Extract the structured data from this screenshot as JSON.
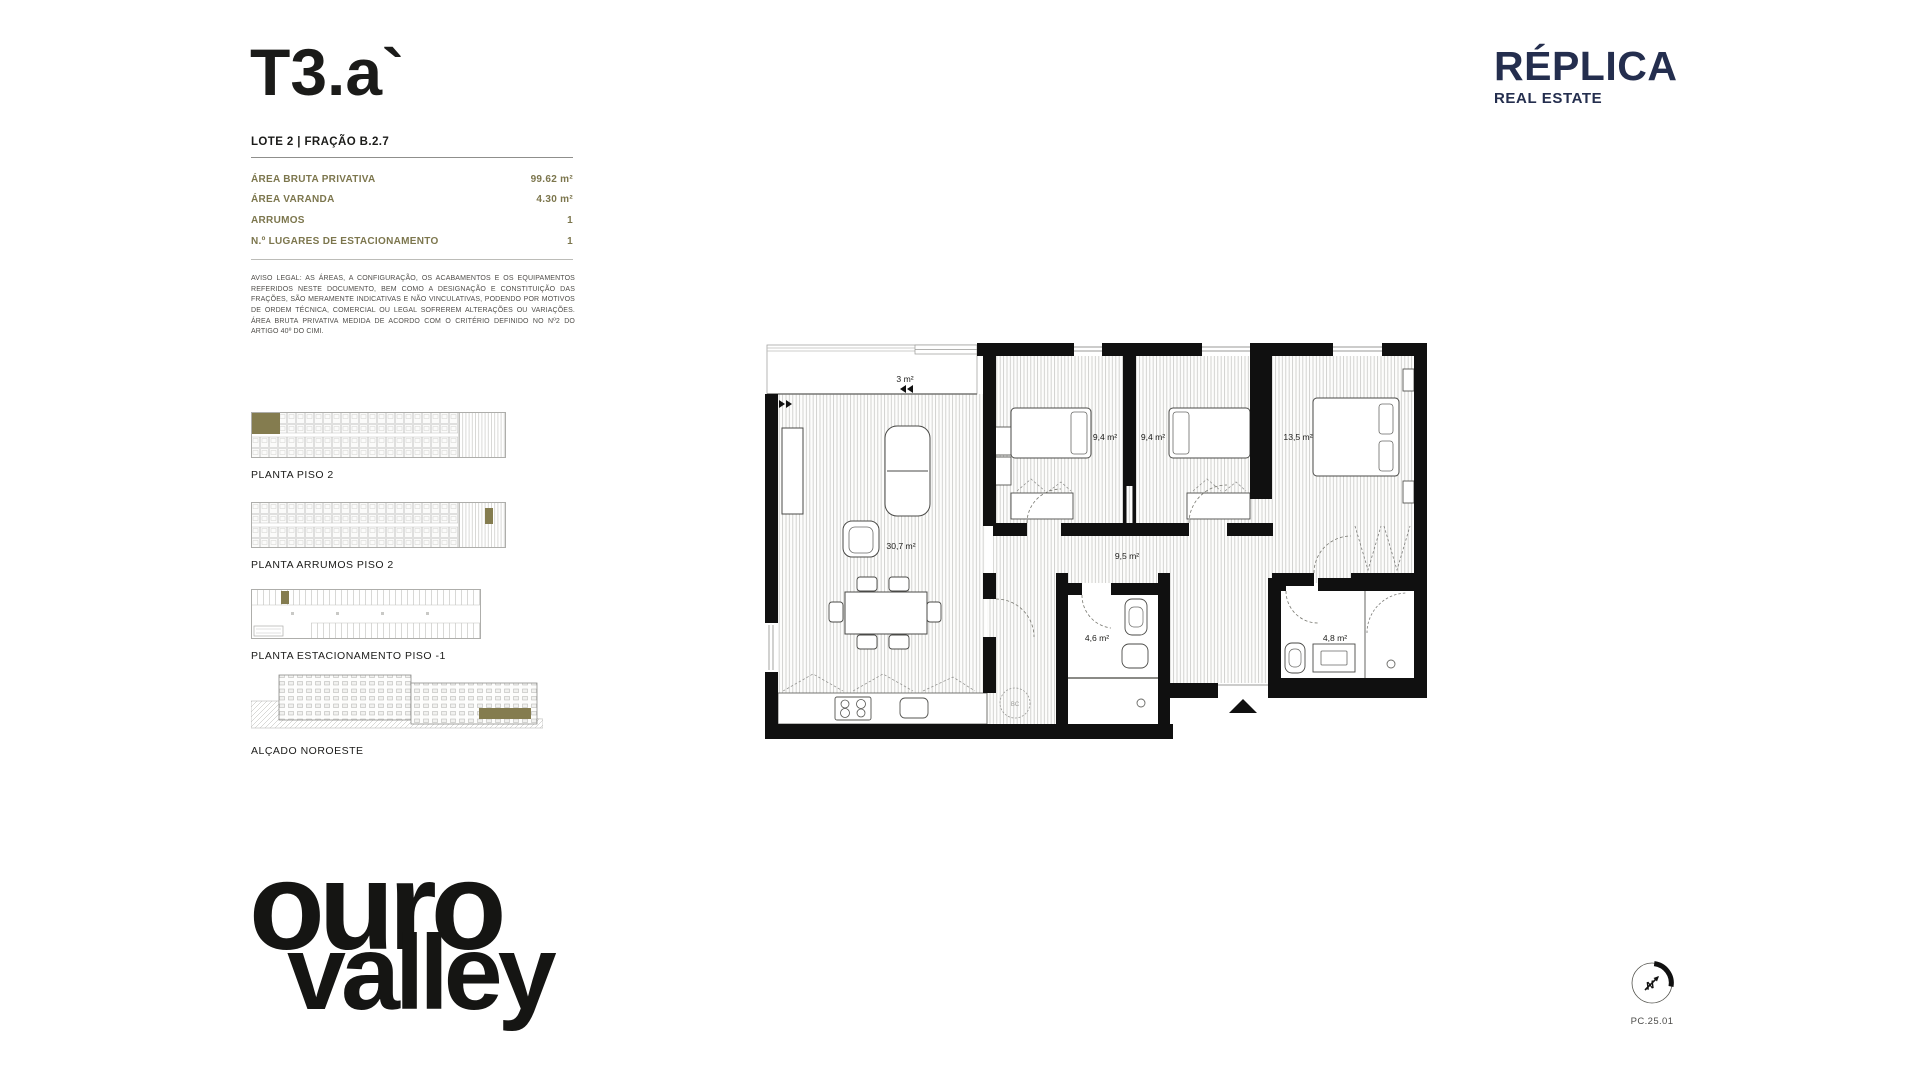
{
  "theme": {
    "accent_olive": "#847C4F",
    "brand_navy": "#242E4E",
    "ink": "#1B1B19"
  },
  "header": {
    "title": "T3.a`",
    "subtitle": "LOTE 2 | FRAÇÃO B.2.7"
  },
  "brand": {
    "name": "RÉPLICA",
    "tagline": "REAL ESTATE"
  },
  "specs": {
    "rows": [
      {
        "label": "ÁREA BRUTA PRIVATIVA",
        "value": "99.62 m²"
      },
      {
        "label": "ÁREA VARANDA",
        "value": "4.30 m²"
      },
      {
        "label": "ARRUMOS",
        "value": "1"
      },
      {
        "label": "N.º LUGARES DE ESTACIONAMENTO",
        "value": "1"
      }
    ]
  },
  "legal": "AVISO LEGAL: AS ÁREAS, A CONFIGURAÇÃO, OS ACABAMENTOS E OS EQUIPAMENTOS REFERIDOS NESTE DOCUMENTO, BEM COMO A DESIGNAÇÃO E CONSTITUIÇÃO DAS FRAÇÕES, SÃO MERAMENTE INDICATIVAS E NÃO VINCULATIVAS, PODENDO POR MOTIVOS DE ORDEM TÉCNICA, COMERCIAL OU LEGAL SOFREREM ALTERAÇÕES OU VARIAÇÕES. ÁREA BRUTA PRIVATIVA MEDIDA DE ACORDO COM O CRITÉRIO DEFINIDO NO Nº2 DO ARTIGO 40º DO CIMI.",
  "thumbnails": [
    {
      "label": "PLANTA PISO 2"
    },
    {
      "label": "PLANTA ARRUMOS PISO 2"
    },
    {
      "label": "PLANTA ESTACIONAMENTO PISO -1"
    },
    {
      "label": "ALÇADO NOROESTE"
    }
  ],
  "floorplan": {
    "rooms": {
      "balcony": "3 m²",
      "living": "30,7 m²",
      "bedroom1": "9,4 m²",
      "bedroom2": "9,4 m²",
      "bedroom3": "13,5 m²",
      "hall": "9,5 m²",
      "bathroom1": "4,6 m²",
      "bathroom2": "4,8 m²"
    },
    "bc_label": "BC"
  },
  "project_logo": {
    "line1": "ouro",
    "line2": "valley"
  },
  "footer": {
    "compass_letter": "N",
    "drawing_code": "PC.25.01"
  }
}
